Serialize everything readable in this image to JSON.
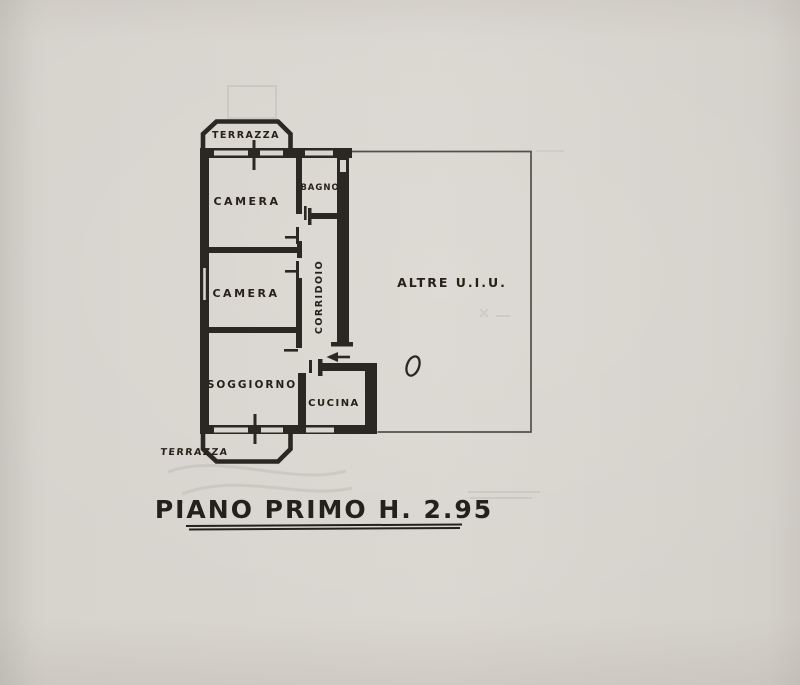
{
  "canvas": {
    "width": 800,
    "height": 685,
    "paper_color": "#d8d4ce",
    "ink_color": "#2b2722",
    "thin_line_color": "#45403a"
  },
  "title": {
    "text": "PIANO PRIMO H. 2.95"
  },
  "rooms": {
    "terrazza_top": "TERRAZZA",
    "camera_top": "CAMERA",
    "bagno": "BAGNO",
    "camera_mid": "CAMERA",
    "corridoio": "CORRIDOIO",
    "soggiorno": "SOGGIORNO",
    "cucina": "CUCINA",
    "terrazza_bottom": "TERRAZZA",
    "altre_uiu": "ALTRE U.I.U."
  },
  "icons": {
    "entrance_arrow": "left-arrow",
    "door_mark": "oval"
  }
}
